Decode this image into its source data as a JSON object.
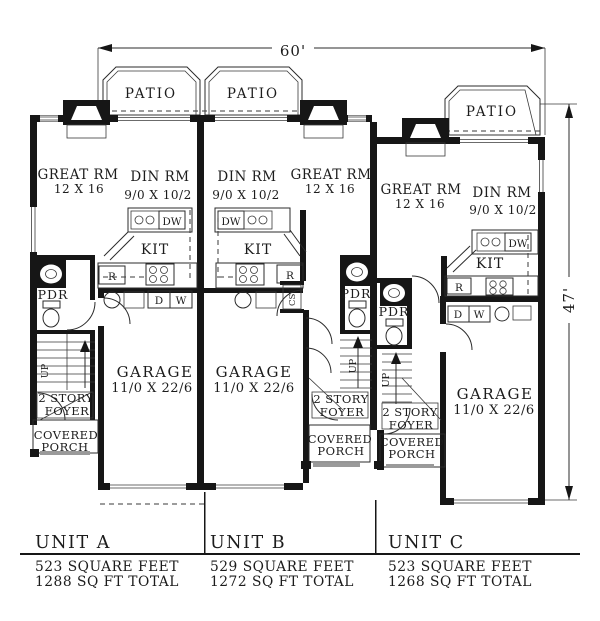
{
  "dimensions": {
    "width": "60'",
    "height": "47'"
  },
  "patios": {
    "a": "PATIO",
    "b": "PATIO",
    "c": "PATIO"
  },
  "units": {
    "a": {
      "great_rm": "GREAT RM",
      "great_rm_dims": "12 X 16",
      "din_rm": "DIN RM",
      "din_rm_dims": "9/0 X 10/2",
      "kitchen": "KIT",
      "garage": "GARAGE",
      "garage_dims": "11/0 X 22/6",
      "powder": "PDR",
      "up": "UP",
      "foyer_line1": "2 STORY",
      "foyer_line2": "FOYER",
      "porch_line1": "COVERED",
      "porch_line2": "PORCH",
      "dishwasher": "DW",
      "fridge": "R",
      "dryer": "D",
      "washer": "W"
    },
    "b": {
      "great_rm": "GREAT RM",
      "great_rm_dims": "12 X 16",
      "din_rm": "DIN RM",
      "din_rm_dims": "9/0 X 10/2",
      "kitchen": "KIT",
      "garage": "GARAGE",
      "garage_dims": "11/0 X 22/6",
      "powder": "PDR",
      "up": "UP",
      "foyer_line1": "2 STORY",
      "foyer_line2": "FOYER",
      "porch_line1": "COVERED",
      "porch_line2": "PORCH",
      "dishwasher": "DW",
      "fridge": "R",
      "closet": "CST"
    },
    "c": {
      "great_rm": "GREAT RM",
      "great_rm_dims": "12 X 16",
      "din_rm": "DIN RM",
      "din_rm_dims": "9/0 X 10/2",
      "kitchen": "KIT",
      "garage": "GARAGE",
      "garage_dims": "11/0 X 22/6",
      "powder": "PDR",
      "up": "UP",
      "foyer_line1": "2 STORY",
      "foyer_line2": "FOYER",
      "porch_line1": "COVERED",
      "porch_line2": "PORCH",
      "dishwasher": "DW",
      "fridge": "R",
      "dryer": "D",
      "washer": "W"
    }
  },
  "footer": {
    "a": {
      "name": "UNIT A",
      "area": "523 SQUARE FEET",
      "total": "1288 SQ FT TOTAL"
    },
    "b": {
      "name": "UNIT B",
      "area": "529 SQUARE FEET",
      "total": "1272 SQ FT TOTAL"
    },
    "c": {
      "name": "UNIT C",
      "area": "523 SQUARE FEET",
      "total": "1268 SQ FT TOTAL"
    }
  }
}
